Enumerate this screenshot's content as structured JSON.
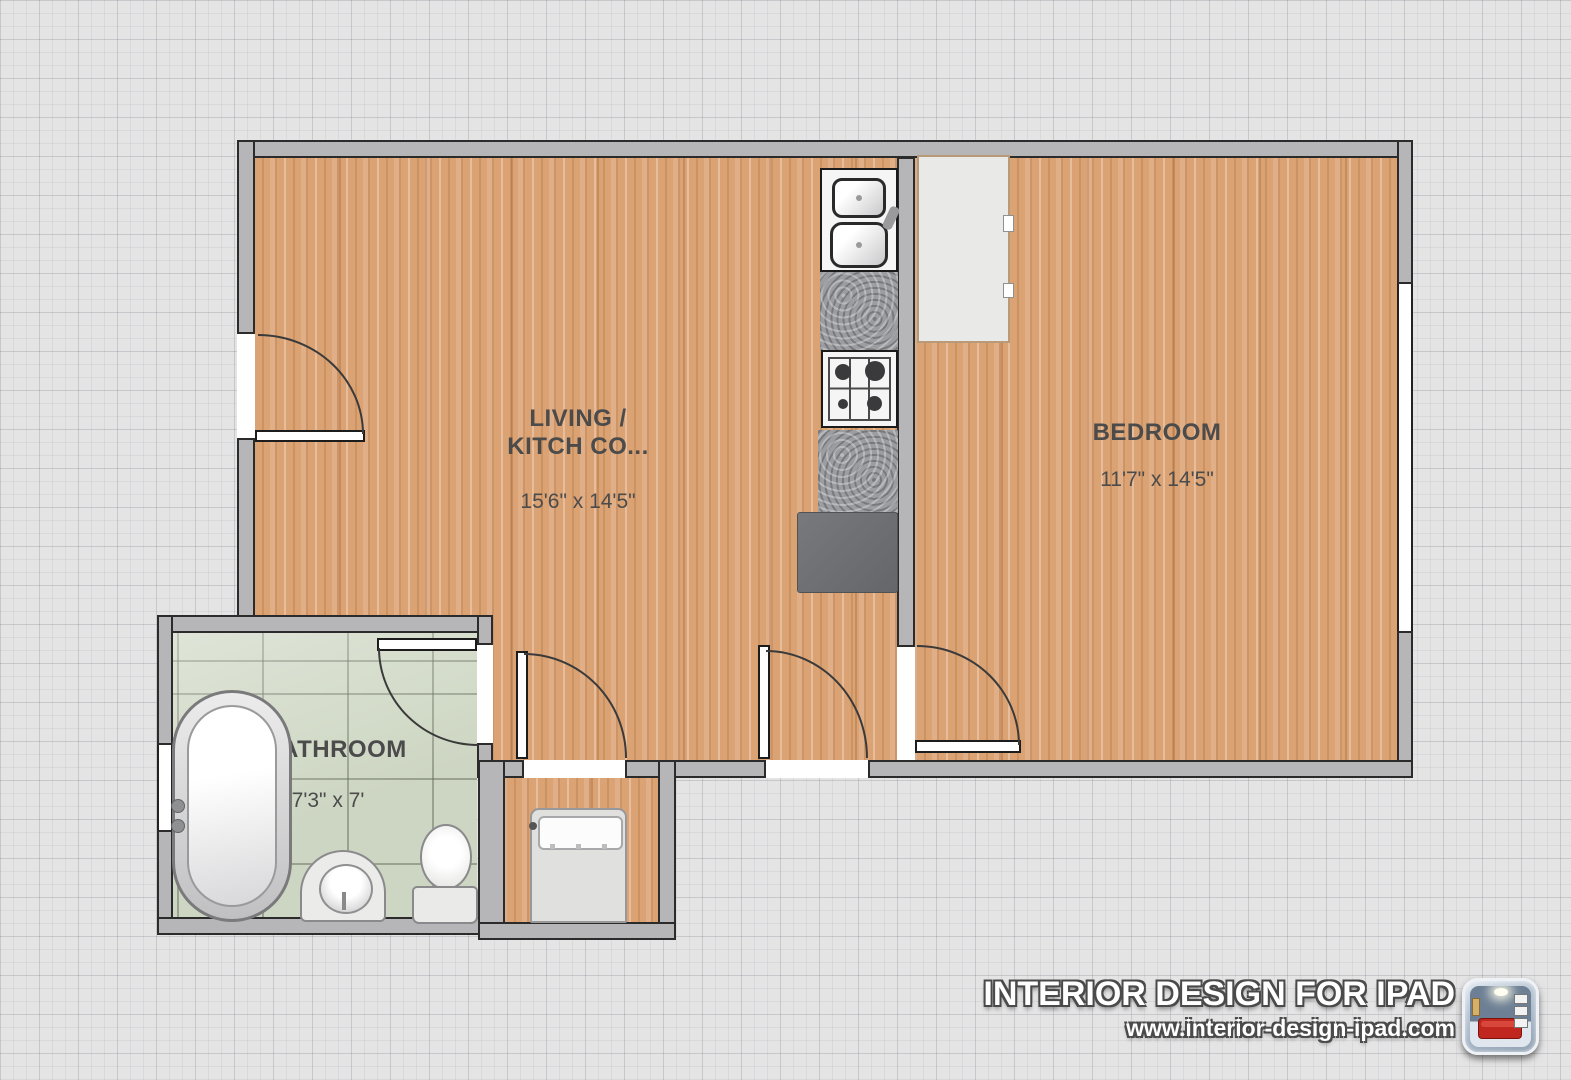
{
  "plan": {
    "rooms": [
      {
        "id": "living-kitchen",
        "label_line1": "LIVING /",
        "label_line2": "KITCH CO...",
        "dimensions": "15'6\" x 14'5\"",
        "floor": "wood"
      },
      {
        "id": "bedroom",
        "label_line1": "BEDROOM",
        "label_line2": "",
        "dimensions": "11'7\" x 14'5\"",
        "floor": "wood"
      },
      {
        "id": "bathroom",
        "label_line1": "BATHROOM",
        "label_line2": "",
        "dimensions": "7'3\" x 7'",
        "floor": "green-tile"
      }
    ],
    "fixtures": [
      "kitchen-sink",
      "granite-counter",
      "stove-cooktop",
      "refrigerator",
      "wardrobe",
      "bed",
      "bathtub",
      "pedestal-sink",
      "toilet"
    ],
    "doors": [
      "entry-door",
      "hall-door-left",
      "hall-door-right",
      "bedroom-door",
      "bathroom-door"
    ],
    "windows": [
      "bedroom-window",
      "bathroom-window"
    ]
  },
  "watermark": {
    "title": "INTERIOR DESIGN FOR IPAD",
    "website": "www.interior-design-ipad.com",
    "icon": "interior-design-app-icon"
  },
  "colors": {
    "background": "#e4e4e5",
    "wall": "#b6b6b8",
    "wall_outline": "#2b2b2b",
    "wood_floor": "#dba273",
    "tile_floor": "#cdd6c2",
    "granite_counter": "#9b9da0",
    "refrigerator": "#6e7072",
    "label_text": "#4b4b4b",
    "watermark_text": "#ffffff"
  }
}
